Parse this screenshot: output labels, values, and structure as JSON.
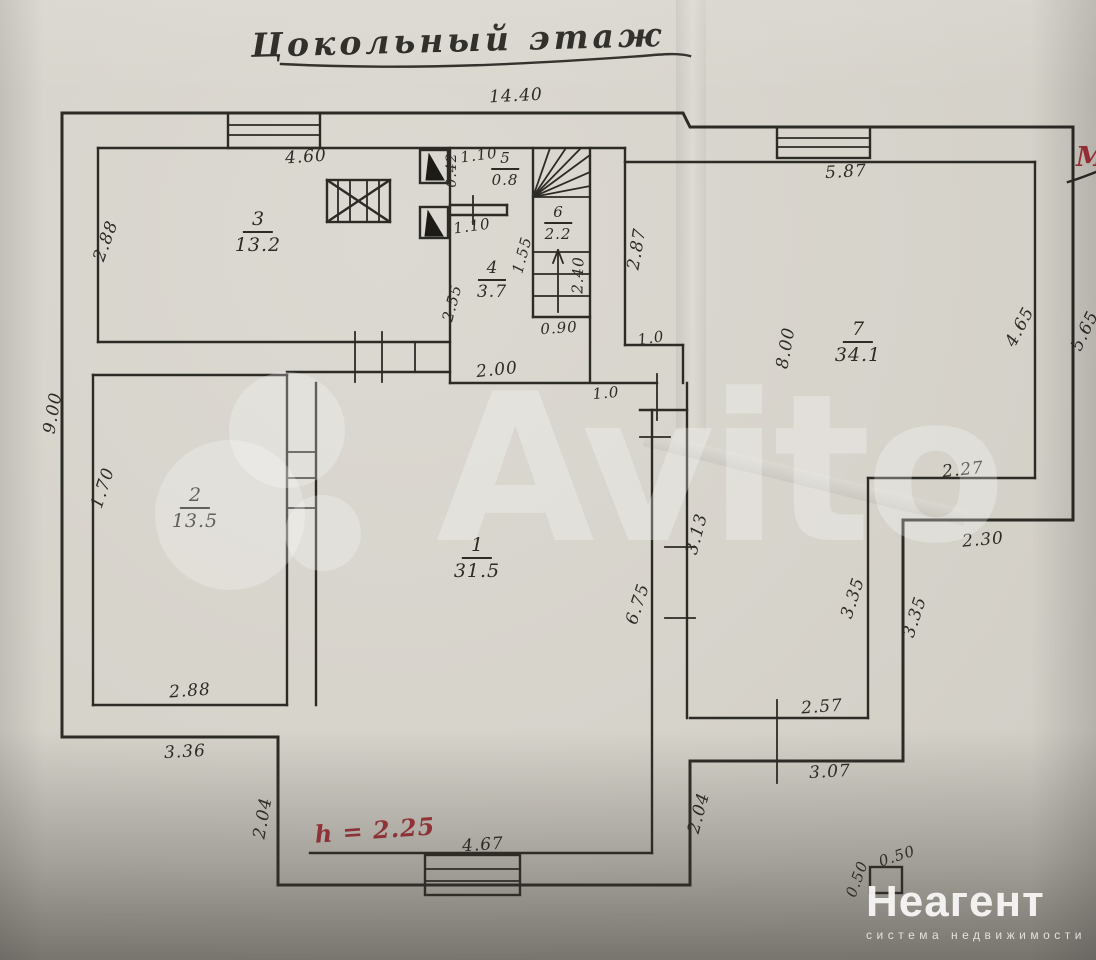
{
  "page": {
    "title": "Цокольный этаж",
    "watermark": "Avito",
    "red_note": "h = 2.25",
    "red_mark": "М",
    "logo": {
      "name": "Неагент",
      "tagline": "система недвижимости"
    }
  },
  "colors": {
    "paper": "#d6d3cb",
    "ink": "#2d2b26",
    "red": "#a8323a",
    "watermark": "#ffffff"
  },
  "rooms": [
    {
      "number": "1",
      "area": "31.5"
    },
    {
      "number": "2",
      "area": "13.5"
    },
    {
      "number": "3",
      "area": "13.2"
    },
    {
      "number": "4",
      "area": "3.7"
    },
    {
      "number": "5",
      "area": "0.8"
    },
    {
      "number": "6",
      "area": "2.2"
    },
    {
      "number": "7",
      "area": "34.1"
    }
  ],
  "dims": [
    "14.40",
    "4.60",
    "2.88",
    "1.10",
    "0.42",
    "1.10",
    "1.55",
    "2.40",
    "2.55",
    "0.90",
    "2.00",
    "1.0",
    "2.87",
    "1.0",
    "5.87",
    "8.00",
    "4.65",
    "5.65",
    "2.27",
    "2.30",
    "3.35",
    "3.35",
    "2.57",
    "3.07",
    "2.04",
    "9.00",
    "1.70",
    "2.88",
    "3.36",
    "2.04",
    "6.75",
    "3.13",
    "4.67",
    "0.50",
    "0.50"
  ]
}
